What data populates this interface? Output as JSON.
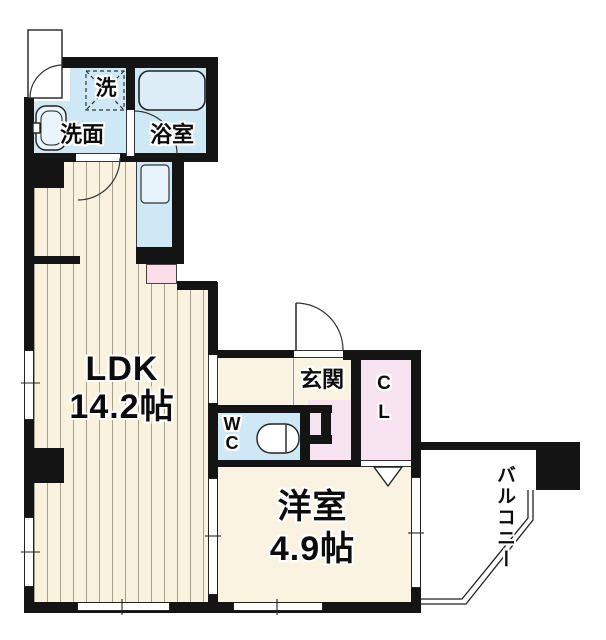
{
  "floorplan": {
    "type": "apartment-floor-plan",
    "rooms": {
      "ldk": {
        "label": "LDK",
        "size": "14.2帖"
      },
      "western_room": {
        "label": "洋室",
        "size": "4.9帖"
      },
      "entrance": {
        "label": "玄関"
      },
      "bathroom": {
        "label": "浴室"
      },
      "washroom": {
        "label": "洗面"
      },
      "laundry": {
        "label": "洗"
      },
      "toilet": {
        "label": "WC"
      },
      "closet": {
        "label": "CL"
      },
      "balcony": {
        "label": "バルコニー"
      }
    },
    "colors": {
      "wall": "#141414",
      "floor_cream": "#faf3e1",
      "ldk_stripe_floor": "#f9f2df",
      "stripe_line": "#a89f8a",
      "water_blue": "#cfe8f5",
      "fixture_blue": "#dcedf8",
      "closet_pink": "#f7e3ef"
    }
  }
}
